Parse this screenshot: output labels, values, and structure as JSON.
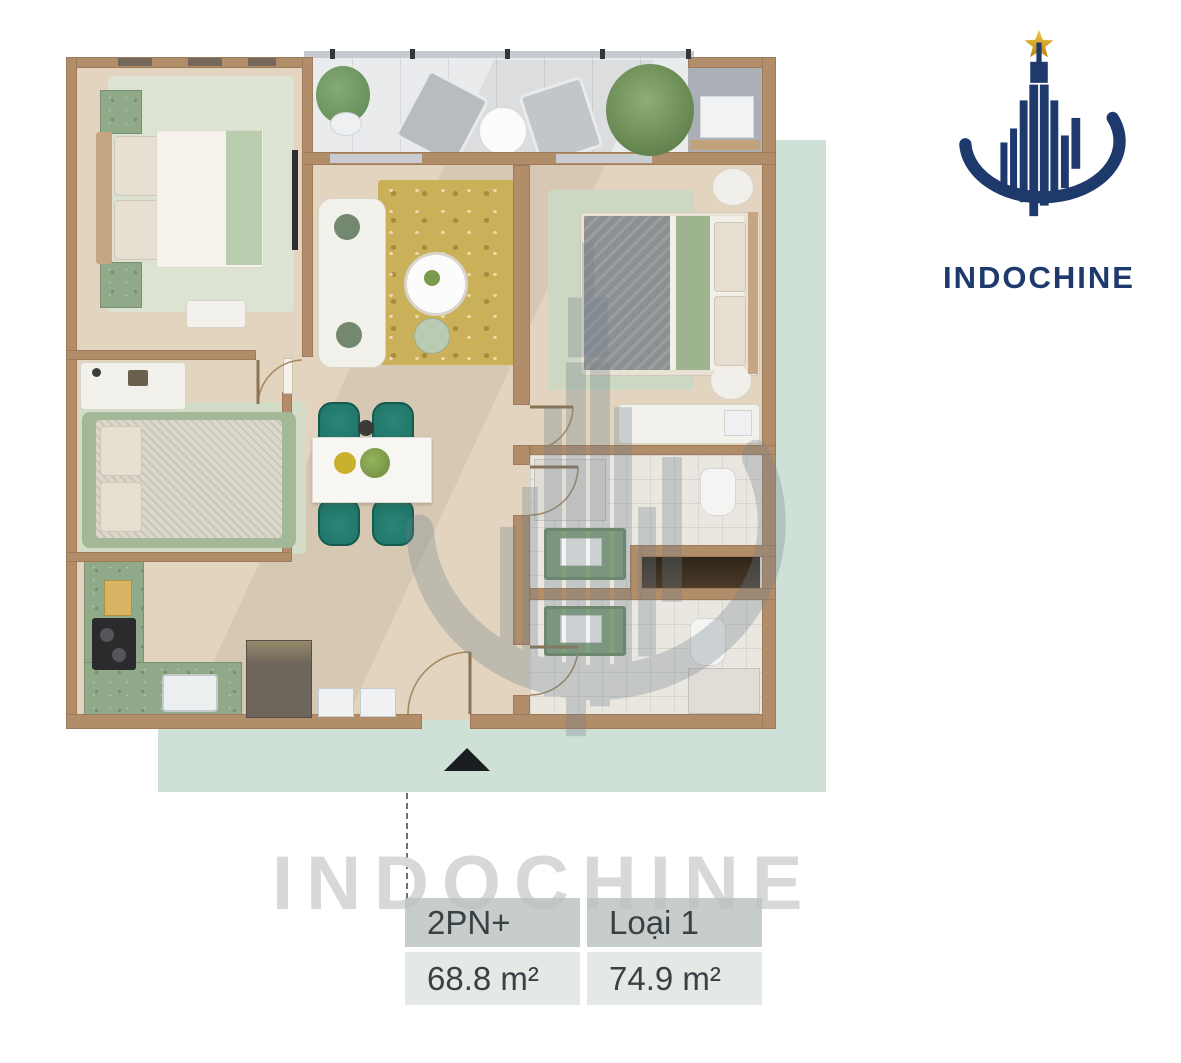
{
  "brand": {
    "name": "INDOCHINE"
  },
  "watermark": {
    "text": "INDOCHINE"
  },
  "spec_table": {
    "columns": [
      {
        "type": "2PN+",
        "area": "68.8 m²"
      },
      {
        "type": "Loại 1",
        "area": "74.9 m²"
      }
    ]
  },
  "plan": {
    "rooms": [
      "bedroom-1",
      "balcony",
      "technical-balcony",
      "living-room",
      "bedroom-2",
      "bedroom-3",
      "kitchen",
      "corridor",
      "bathroom-1",
      "bathroom-2",
      "storage-niche"
    ],
    "entrance_marker": "triangle-up"
  },
  "colors": {
    "navy": "#1e3a6d",
    "gold": "#d9a92c",
    "green_backdrop": "#cfe0d6",
    "wall": "#b28d69",
    "floor": "#e2d4be",
    "teal_chair": "#1c6f63",
    "counter_green": "#8fa989",
    "watermark": "#d6d8da",
    "text_dark": "#3a4145"
  }
}
